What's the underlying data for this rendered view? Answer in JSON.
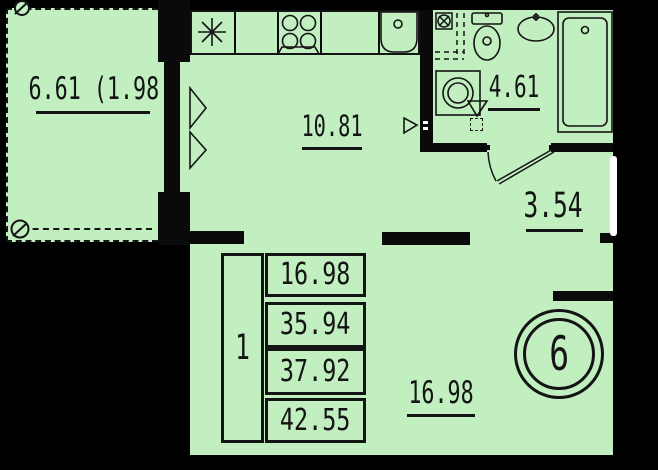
{
  "colors": {
    "background": "#000000",
    "room_fill": "#c1efc0",
    "line": "#141414",
    "door_leaf": "#ffffff"
  },
  "rooms": {
    "balcony": {
      "area_label": "6.61 (1.98 )"
    },
    "kitchen": {
      "area_label": "10.81"
    },
    "bathroom": {
      "area_label": "4.61"
    },
    "hallway": {
      "area_label": "3.54"
    },
    "living_room": {
      "area_label": "16.98"
    }
  },
  "area_table": {
    "room_count": "1",
    "rows": [
      "16.98",
      "35.94",
      "37.92",
      "42.55"
    ]
  },
  "unit_badge": {
    "number": "6"
  },
  "icons": {
    "fridge": "eight-spoke-star",
    "stove": "four-burner-circles",
    "kitchen_sink": "rounded-basin-with-drain-hole",
    "toilet": "tank-and-bowl",
    "washbasin": "oval-basin-with-tap",
    "bathtub": "rect-tub-with-drain-hole",
    "washing_machine": "square-with-double-circle",
    "floor_drain": "triangle-funnel",
    "vent_shaft": "square-with-crossed-circle-and-dashed-duct",
    "window_casement": "double-open-triangle",
    "door_swing": "arc-with-leaf",
    "section_marker": "circle-with-diagonal"
  }
}
